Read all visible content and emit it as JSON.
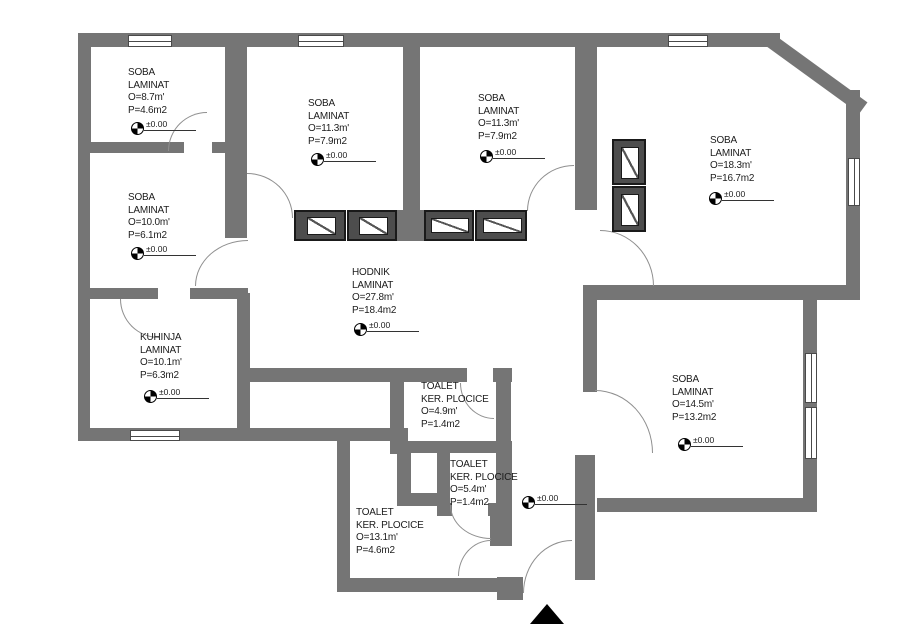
{
  "plan_title": "Apartment floor plan",
  "elevation_label": "±0.00",
  "colors": {
    "wall": "#757575",
    "furniture": "#4d4d4d",
    "background": "#ffffff",
    "text": "#1c1c1c"
  },
  "rooms": [
    {
      "id": "soba-top-left",
      "name": "SOBA",
      "floor": "LAMINAT",
      "perimeter": "O=8.7m'",
      "area": "P=4.6m2",
      "has_marker": true,
      "label_x": 128,
      "label_y": 66,
      "marker_x": 131,
      "marker_y": 122
    },
    {
      "id": "soba-top-mid-1",
      "name": "SOBA",
      "floor": "LAMINAT",
      "perimeter": "O=11.3m'",
      "area": "P=7.9m2",
      "has_marker": true,
      "label_x": 308,
      "label_y": 97,
      "marker_x": 311,
      "marker_y": 153
    },
    {
      "id": "soba-top-mid-2",
      "name": "SOBA",
      "floor": "LAMINAT",
      "perimeter": "O=11.3m'",
      "area": "P=7.9m2",
      "has_marker": true,
      "label_x": 478,
      "label_y": 92,
      "marker_x": 480,
      "marker_y": 150
    },
    {
      "id": "soba-right",
      "name": "SOBA",
      "floor": "LAMINAT",
      "perimeter": "O=18.3m'",
      "area": "P=16.7m2",
      "has_marker": true,
      "label_x": 710,
      "label_y": 134,
      "marker_x": 709,
      "marker_y": 192
    },
    {
      "id": "soba-left",
      "name": "SOBA",
      "floor": "LAMINAT",
      "perimeter": "O=10.0m'",
      "area": "P=6.1m2",
      "has_marker": true,
      "label_x": 128,
      "label_y": 191,
      "marker_x": 131,
      "marker_y": 247
    },
    {
      "id": "kuhinja",
      "name": "KUHINJA",
      "floor": "LAMINAT",
      "perimeter": "O=10.1m'",
      "area": "P=6.3m2",
      "has_marker": true,
      "label_x": 140,
      "label_y": 331,
      "marker_x": 144,
      "marker_y": 390
    },
    {
      "id": "hodnik",
      "name": "HODNIK",
      "floor": "LAMINAT",
      "perimeter": "O=27.8m'",
      "area": "P=18.4m2",
      "has_marker": true,
      "label_x": 352,
      "label_y": 266,
      "marker_x": 354,
      "marker_y": 323
    },
    {
      "id": "toalet-1",
      "name": "TOALET",
      "floor": "KER. PLOCICE",
      "perimeter": "O=4.9m'",
      "area": "P=1.4m2",
      "has_marker": false,
      "label_x": 421,
      "label_y": 380
    },
    {
      "id": "toalet-2",
      "name": "TOALET",
      "floor": "KER. PLOCICE",
      "perimeter": "O=5.4m'",
      "area": "P=1.4m2",
      "has_marker": false,
      "label_x": 450,
      "label_y": 458
    },
    {
      "id": "toalet-3",
      "name": "TOALET",
      "floor": "KER. PLOCICE",
      "perimeter": "O=13.1m'",
      "area": "P=4.6m2",
      "has_marker": false,
      "label_x": 356,
      "label_y": 506
    },
    {
      "id": "soba-bottom-right",
      "name": "SOBA",
      "floor": "LAMINAT",
      "perimeter": "O=14.5m'",
      "area": "P=13.2m2",
      "has_marker": true,
      "label_x": 672,
      "label_y": 373,
      "marker_x": 678,
      "marker_y": 438
    }
  ],
  "entry_marker": {
    "id": "entry-hall",
    "x": 522,
    "y": 496,
    "label": "±0.00"
  },
  "icons": {
    "benchmark": "quartered survey circle",
    "entrance_arrow": "solid black triangle pointing up"
  }
}
